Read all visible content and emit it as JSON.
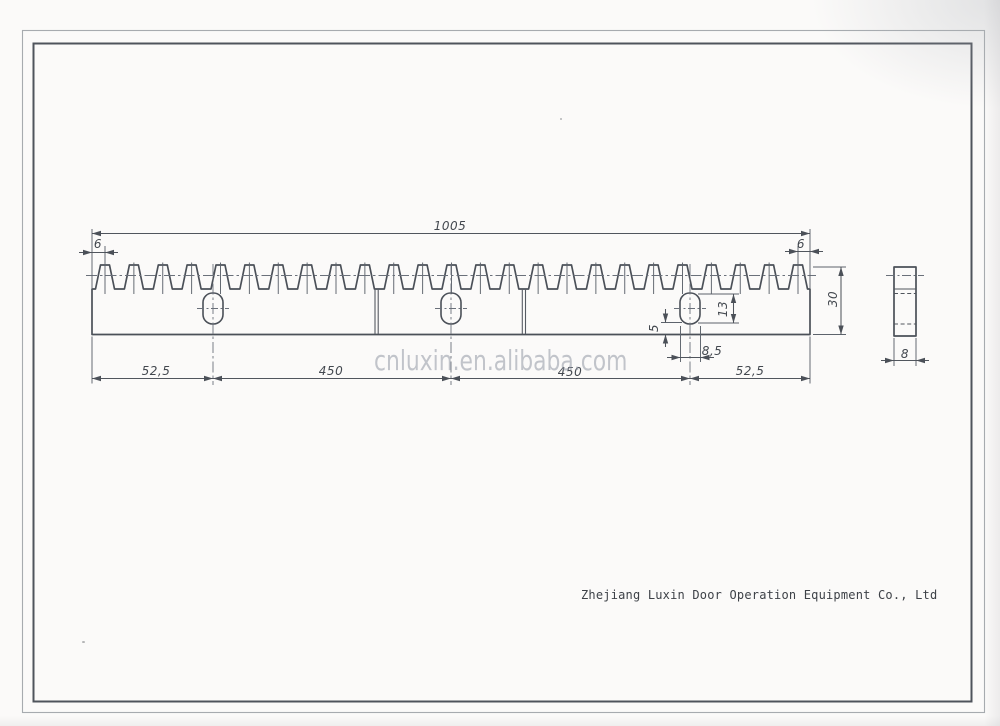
{
  "drawing": {
    "watermark": "cnluxin.en.alibaba.com",
    "company": "Zhejiang Luxin Door Operation Equipment Co., Ltd",
    "front_view": {
      "total_length": "1005",
      "left_end_offset": "6",
      "right_end_offset": "6",
      "height": "30",
      "left_edge_to_hole": "52,5",
      "hole_spacing_left": "450",
      "hole_spacing_right": "450",
      "hole_to_right_edge": "52,5",
      "hole": {
        "height": "13",
        "width": "8,5",
        "bottom_offset": "5"
      }
    },
    "side_view": {
      "thickness": "8"
    }
  }
}
